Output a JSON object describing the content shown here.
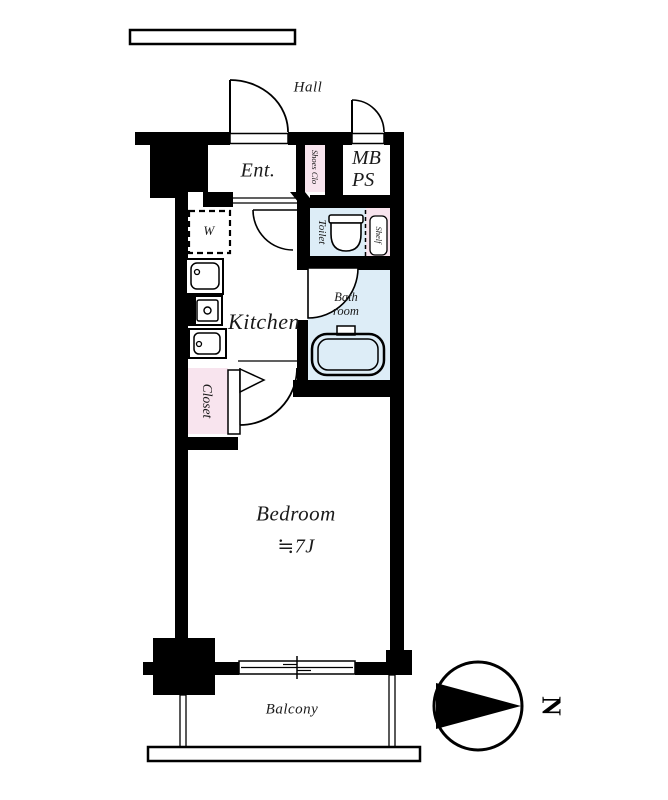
{
  "title": "Studio apartment floor plan",
  "colors": {
    "wall": "#000000",
    "room_blue": "#ddedf7",
    "room_pink": "#f8e4ee",
    "background": "#ffffff"
  },
  "rooms": {
    "hall": {
      "label": "Hall"
    },
    "entrance": {
      "label": "Ent."
    },
    "shoes_closet": {
      "label": "Shoes Clo"
    },
    "meter_box": {
      "label": "MB"
    },
    "pipe_space": {
      "label": "PS"
    },
    "washer": {
      "label": "W"
    },
    "toilet": {
      "label": "Toilet"
    },
    "shelf": {
      "label": "Shelf"
    },
    "kitchen": {
      "label": "Kitchen"
    },
    "bathroom": {
      "label_line1": "Bath",
      "label_line2": "room"
    },
    "closet": {
      "label": "Closet"
    },
    "bedroom": {
      "label": "Bedroom",
      "size": "≒7J"
    },
    "balcony": {
      "label": "Balcony"
    }
  },
  "compass": {
    "north_label": "N"
  }
}
